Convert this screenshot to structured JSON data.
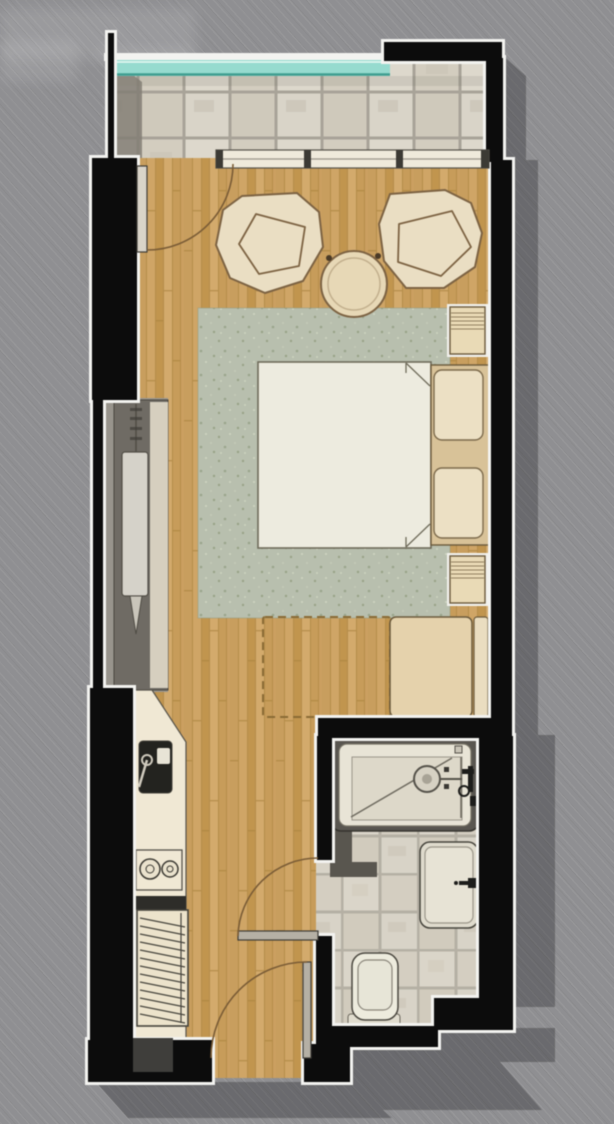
{
  "meta": {
    "description": "Top-down architectural floor plan of a narrow studio apartment with balcony, lounge chairs, round table, bed on rug, wardrobe, kitchenette, entry and bathroom with shower, washbasin and toilet",
    "canvas": {
      "width": 614,
      "height": 1124
    }
  },
  "colors": {
    "background": "#8f8f92",
    "shadow": "#17171c",
    "wallBlack": "#0c0c0c",
    "wallOutline": "#f3f3f0",
    "glassTeal": "#96dbcf",
    "glassTealEdge": "#3f9e90",
    "glassTealHighlight": "#e9f9f5",
    "stoneTileBase": "#a8a398",
    "bathTileBase": "#b5b0a4",
    "woodLine": "#ab843f",
    "rugBase": "#b8bfae",
    "bedFill": "#edebdf",
    "bedStroke": "#6f6b5a",
    "headboardFill": "#d8c298",
    "pillowFill": "#ece0c4",
    "chairFill": "#eadec3",
    "chairStroke": "#7d6343",
    "tableFill": "#e7d8b6",
    "nightstandFill": "#e9dab6",
    "furnitureStroke": "#6b5a3c",
    "deskFill": "#e5d2ac",
    "deskStripFill": "#eaddc0",
    "dashedOutline": "#8a6b35",
    "counterFill": "#f0e8d4",
    "counterStroke": "#55524a",
    "sinkDark": "#23231f",
    "applianceDark": "#2e2d29",
    "hatchUnitFill": "#ece3cb",
    "hatchLine": "#46443c",
    "wardrobeBody": "#6f6b64",
    "wardrobeAlcove": "#98948c",
    "wardrobePanel": "#d5d2c9",
    "wardrobeStrip": "#d6cfbf",
    "tubSurround": "#595650",
    "tubFill": "#e8e4d6",
    "tubFloor": "#ddd8c9",
    "fixtureDark": "#1d1d1b",
    "toiletFill": "#edebdd",
    "doorArc": "#7a5c36",
    "doorLeaf": "#b5b0a5",
    "windowFrame": "#efeadb",
    "windowMullion": "#3c3a34",
    "insetDark": "#3f3e3b",
    "balconyWedge": "#827e74"
  },
  "legend": {
    "areas": [
      "balcony",
      "living-sleeping-area",
      "wardrobe-alcove",
      "kitchenette",
      "entry",
      "bathroom"
    ],
    "objects": [
      "glass-railing",
      "sliding-window",
      "balcony-door",
      "lounge-chair",
      "lounge-chair",
      "round-table",
      "rug",
      "double-bed",
      "pillows",
      "nightstand",
      "nightstand",
      "desk-bench",
      "dashed-clearance",
      "wardrobe",
      "kitchen-sink",
      "cooktop",
      "grille-unit",
      "shower-tub",
      "shower-head",
      "washbasin",
      "toilet",
      "bathroom-door",
      "entry-door"
    ]
  }
}
